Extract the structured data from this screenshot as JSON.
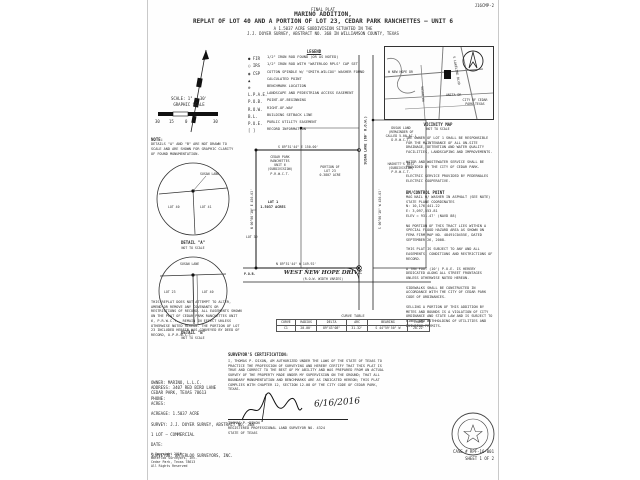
{
  "document": {
    "ref_number": "J16CMP-2",
    "margin_note": "Doc.# 2016063602",
    "case_number": "CASE # RPF-16-001",
    "sheet_number": "SHEET 1 OF 2"
  },
  "title_block": {
    "pre_title": "FINAL PLAT",
    "title": "MARINO ADDITION,",
    "subtitle": "REPLAT OF LOT 40 AND A PORTION OF LOT 23, CEDAR PARK RANCHETTES — UNIT 6",
    "line3": "A 1.5037 ACRE SUBDIVISION SITUATED IN THE",
    "line4": "J.J. DOYER SURVEY, ABSTRACT NO. 368 IN WILLIAMSON COUNTY, TEXAS"
  },
  "scale_block": {
    "scale_label": "SCALE: 1\" = 30'",
    "graphic_label": "GRAPHIC SCALE",
    "ticks": [
      "30",
      "15",
      "0",
      "30"
    ]
  },
  "legend": {
    "heading": "LEGEND",
    "items": [
      {
        "symbol": "● FIR",
        "label": "1/2\" IRON ROD FOUND (OR AS NOTED)"
      },
      {
        "symbol": "○ IRS",
        "label": "1/2\" IRON ROD WITH \"WATERLOO RPLS\" CAP SET"
      },
      {
        "symbol": "◉ CSP",
        "label": "COTTON SPINDLE W/ \"SMITH-WILCOX\" WASHER FOUND"
      },
      {
        "symbol": "▲",
        "label": "CALCULATED POINT"
      },
      {
        "symbol": "⊗",
        "label": "BENCHMARK LOCATION"
      },
      {
        "symbol": "L.P.A.E.",
        "label": "LANDSCAPE AND PEDESTRIAN ACCESS EASEMENT"
      },
      {
        "symbol": "P.O.B.",
        "label": "POINT-OF-BEGINNING"
      },
      {
        "symbol": "R.O.W.",
        "label": "RIGHT-OF-WAY"
      },
      {
        "symbol": "B.L.",
        "label": "BUILDING SETBACK LINE"
      },
      {
        "symbol": "P.U.E.",
        "label": "PUBLIC UTILITY EASEMENT"
      },
      {
        "symbol": "[  ]",
        "label": "RECORD INFORMATION"
      }
    ]
  },
  "vicinity_map": {
    "caption": "VICINITY MAP",
    "subcaption": "NOT TO SCALE",
    "city_label": "CITY OF CEDAR PARK TEXAS",
    "streets": {
      "s1": "W NEW HOPE DR",
      "s2": "SUSAN LN",
      "s3": "ANITA DR",
      "s4": "S LAKELINE BLVD"
    }
  },
  "note_block": {
    "heading": "NOTE:",
    "text": "DETAILS \"A\" AND \"B\" ARE NOT DRAWN TO SCALE AND ARE SHOWN FOR GRAPHIC CLARITY OF FOUND MONUMENTATION."
  },
  "details": {
    "a": {
      "caption": "DETAIL \"A\"",
      "subcaption": "NOT TO SCALE",
      "label1": "SUSAN LANE",
      "label2": "LOT 40",
      "label3": "LOT 41"
    },
    "b": {
      "caption": "DETAIL \"B\"",
      "subcaption": "NOT TO SCALE",
      "label1": "SUSAN LANE",
      "label2": "LOT 23",
      "label3": "LOT 40"
    }
  },
  "plat": {
    "subdivision_label": "CEDAR PARK\nRANCHETTES\nUNIT 6\n(SUBDIVISION)\nP.R.W.C.T.",
    "lot1_label": "LOT 1\n1.5037 ACRES",
    "lot23_label": "PORTION OF\nLOT 23\n0.3807 ACRE",
    "lot39_label": "LOT 39",
    "dusak_label": "DUSAK LAND\n(REMAINDER OF\nCALLED 5.00 AC.)\nD.R.W.C.T.",
    "haskett_label": "HASKETT'S BEST\n(SUBDIVISION)\nP.R.W.C.T.",
    "street_main": "WEST NEW HOPE DRIVE",
    "street_main_sub": "(R.O.W. WIDTH VARIES)",
    "street_side": "SUSAN LANE (60' R.O.W.)",
    "bearing_top": "S 89°51'44\" E  150.00'",
    "bearing_bottom": "N 89°51'44\" W  149.92'",
    "bearing_left": "N 00°08'16\" E  436.63'",
    "bearing_right": "S 00°08'16\" W  436.63'",
    "pob_label": "P.O.B."
  },
  "curve_table": {
    "title": "CURVE TABLE",
    "headers": [
      "CURVE",
      "RADIUS",
      "DELTA",
      "ARC",
      "BEARING",
      "CHORD"
    ],
    "row": [
      "C1",
      "20.00'",
      "89°43'08\"",
      "31.32'",
      "S 44°59'50\" W",
      "28.22'"
    ]
  },
  "left_notes": {
    "text": "THIS REPLAT DOES NOT ATTEMPT TO ALTER, AMEND OR REMOVE ANY COVENANTS OR RESTRICTIONS OF RECORD. ALL EASEMENTS SHOWN ON THE PLAT OF CEDAR PARK RANCHETTES UNIT 6, P.R.W.C.T., REMAIN IN EFFECT UNLESS OTHERWISE NOTED HEREON. THE PORTION OF LOT 23 INCLUDED HEREIN WAS CONVEYED BY DEED OF RECORD, O.P.R.W.C.T."
  },
  "right_notes": {
    "p1": "THE OWNER OF LOT 1 SHALL BE RESPONSIBLE FOR THE MAINTENANCE OF ALL ON-SITE DRAINAGE, DETENTION AND WATER QUALITY FACILITIES, LANDSCAPING AND IMPROVEMENTS.",
    "p2": "WATER AND WASTEWATER SERVICE SHALL BE PROVIDED BY THE CITY OF CEDAR PARK.",
    "p3": "ELECTRIC SERVICE PROVIDED BY PEDERNALES ELECTRIC COOPERATIVE.",
    "bm_heading": "BM/CONTROL POINT",
    "bm_lines": "MAG NAIL W/ WASHER IN ASPHALT (SEE NOTE)\nSTATE PLANE COORDINATES\nN: 10,176,441.22\nE: 3,097,553.81\nELEV = 931.47' (NAVD 88)",
    "p4": "NO PORTION OF THIS TRACT LIES WITHIN A SPECIAL FLOOD HAZARD AREA AS SHOWN ON FEMA FIRM MAP NO. 48491C0455E, DATED SEPTEMBER 26, 2008.",
    "p5": "THIS PLAT IS SUBJECT TO ANY AND ALL EASEMENTS, CONDITIONS AND RESTRICTIONS OF RECORD.",
    "p6": "A TEN FOOT (10') P.U.E. IS HEREBY DEDICATED ALONG ALL STREET FRONTAGES UNLESS OTHERWISE NOTED HEREON.",
    "p7": "SIDEWALKS SHALL BE CONSTRUCTED IN ACCORDANCE WITH THE CITY OF CEDAR PARK CODE OF ORDINANCES.",
    "p8": "SELLING A PORTION OF THIS ADDITION BY METES AND BOUNDS IS A VIOLATION OF CITY ORDINANCE AND STATE LAW AND IS SUBJECT TO FINES AND WITHHOLDING OF UTILITIES AND BUILDING PERMITS."
  },
  "certification": {
    "heading": "SURVEYOR'S CERTIFICATION:",
    "body": "I, THOMAS P. DIXON, AM AUTHORIZED UNDER THE LAWS OF THE STATE OF TEXAS TO PRACTICE THE PROFESSION OF SURVEYING AND HEREBY CERTIFY THAT THIS PLAT IS TRUE AND CORRECT TO THE BEST OF MY ABILITY AND WAS PREPARED FROM AN ACTUAL SURVEY OF THE PROPERTY MADE UNDER MY SUPERVISION ON THE GROUND; THAT ALL BOUNDARY MONUMENTATION AND BENCHMARKS ARE AS INDICATED HEREON; THIS PLAT COMPLIES WITH CHAPTER 12, SECTION 12.08 OF THE CITY CODE OF CEDAR PARK, TEXAS.",
    "signature_date": "6/16/2016",
    "name": "THOMAS P. DIXON",
    "title_line": "REGISTERED PROFESSIONAL LAND SURVEYOR NO. 4324",
    "state_line": "STATE OF TEXAS"
  },
  "owner_block": {
    "text": "OWNER:  MARINO, L.L.C.\n    ADDRESS: 3407 RED BIRD LANE\n    CEDAR PARK, TEXAS 78613\n    PHONE:\n    ACRES:\n\nACREAGE:  1.5037 ACRE\n\nSURVEY:  J.J. DOYER SURVEY, ABSTRACT NO. 368\n\n1 LOT — COMMERCIAL\n\nDATE:\n\nSURVEYOR:  WATERLOO SURVEYORS, INC."
  },
  "copyright_block": {
    "text": "© Copyright 2016\nWaterloo Surveyors, Inc.\nCedar Park, Texas 78613\nAll Rights Reserved"
  }
}
